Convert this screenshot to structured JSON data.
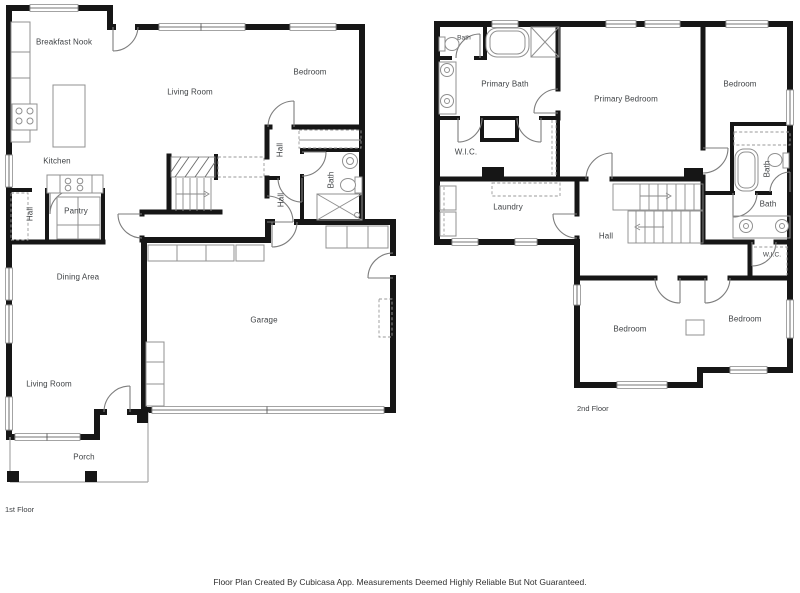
{
  "colors": {
    "wall": "#161616",
    "fixture": "#909090",
    "door_arc": "#7d7d7d",
    "label_text": "#3f4245",
    "background": "#ffffff"
  },
  "floors": [
    {
      "label": "1st Floor",
      "rooms": {
        "breakfast_nook": "Breakfast Nook",
        "living_room_upper": "Living Room",
        "bedroom": "Bedroom",
        "kitchen": "Kitchen",
        "hall_upper": "Hall",
        "bath": "Bath",
        "hall_lower": "Hall",
        "hall_entry": "Hall",
        "pantry": "Pantry",
        "dining_area": "Dining Area",
        "garage": "Garage",
        "living_room_lower": "Living Room",
        "porch": "Porch"
      }
    },
    {
      "label": "2nd Floor",
      "rooms": {
        "bath_top": "Bath",
        "primary_bath": "Primary Bath",
        "primary_bedroom": "Primary Bedroom",
        "bedroom_top_right": "Bedroom",
        "wic": "W.I.C.",
        "bath_right": "Bath",
        "bath_center": "Bath",
        "laundry": "Laundry",
        "hall": "Hall",
        "wic_small": "W.I.C.",
        "bedroom_bottom_left": "Bedroom",
        "bedroom_bottom_right": "Bedroom"
      }
    }
  ],
  "footer": {
    "disclaimer": "Floor Plan Created By Cubicasa App. Measurements Deemed Highly Reliable But Not Guaranteed."
  }
}
